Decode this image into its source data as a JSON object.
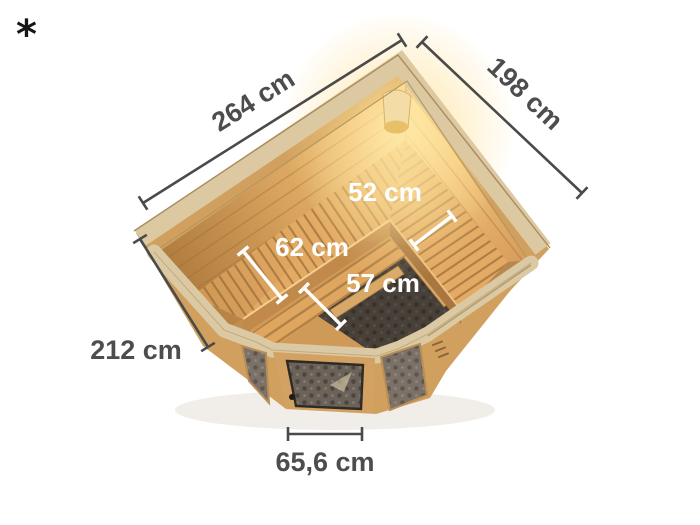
{
  "footnote": "*",
  "illustration": {
    "subject": "corner sauna top view",
    "colors": {
      "background": "#ffffff",
      "dimension_line": "#4a4a4a",
      "dimension_label": "#4d4d4d",
      "inner_dimension_label": "#ffffff",
      "wood_mid": "#d2a05f",
      "wood_light": "#f6d193",
      "rim_frame": "#dbc9a3",
      "bench_wood": "#e3aa63",
      "glass": "#7b7168",
      "heater_pit": "#332c25",
      "lamp_glow": "#ffe9a8"
    }
  },
  "dimensions": {
    "outer": [
      {
        "id": "back-left-wall",
        "label": "264 cm"
      },
      {
        "id": "back-right-wall",
        "label": "198 cm"
      },
      {
        "id": "front-left-wall",
        "label": "212 cm"
      },
      {
        "id": "door-width",
        "label": "65,6 cm"
      }
    ],
    "inner": [
      {
        "id": "right-bench-depth",
        "label": "52 cm"
      },
      {
        "id": "upper-bench-depth",
        "label": "62 cm"
      },
      {
        "id": "lower-bench-depth",
        "label": "57 cm"
      }
    ]
  }
}
